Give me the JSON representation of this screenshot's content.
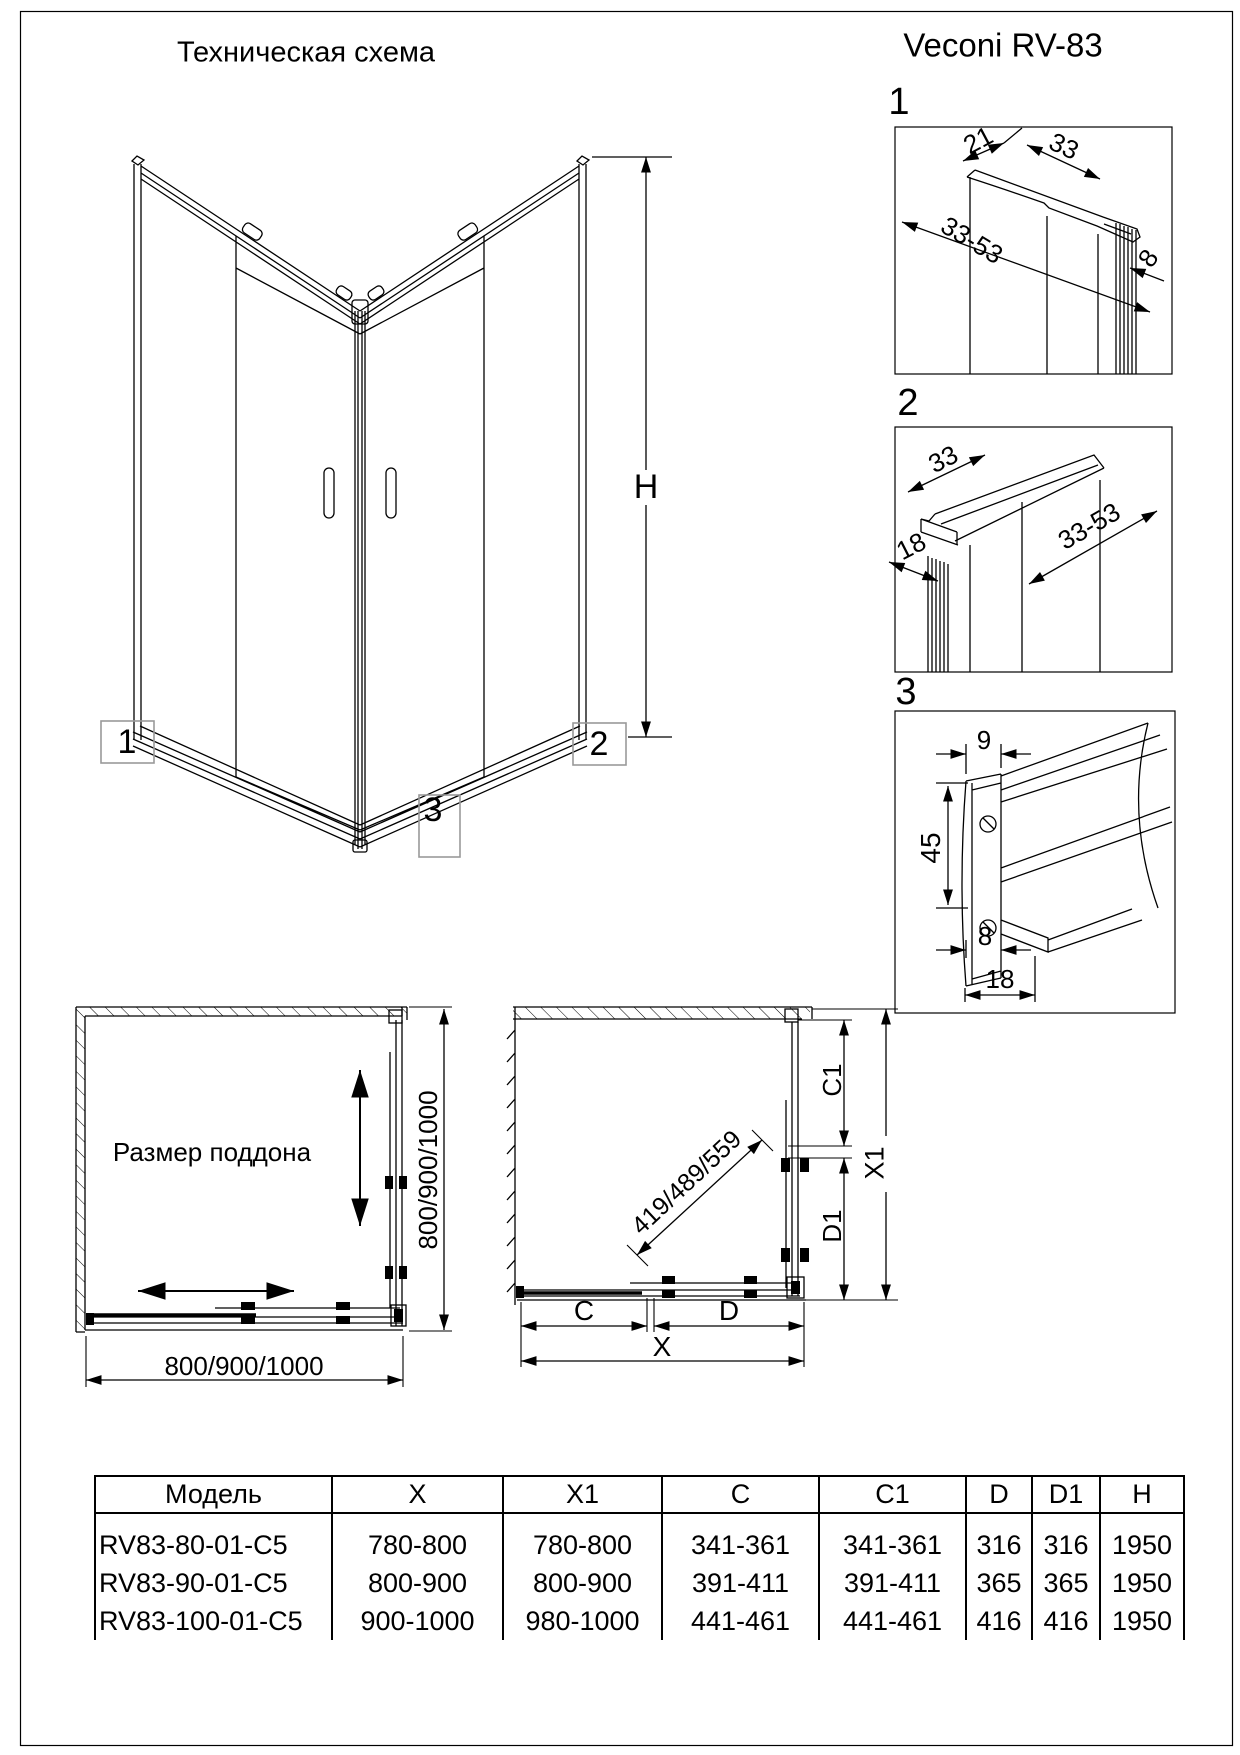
{
  "page": {
    "title": "Техническая схема",
    "brand": "Veconi RV-83"
  },
  "main_drawing": {
    "height_label": "H",
    "callouts": [
      "1",
      "2",
      "3"
    ]
  },
  "details": [
    {
      "number": "1",
      "dims": [
        "21",
        "33",
        "33-53",
        "8"
      ]
    },
    {
      "number": "2",
      "dims": [
        "33",
        "18",
        "33-53"
      ]
    },
    {
      "number": "3",
      "dims": [
        "9",
        "45",
        "8",
        "18"
      ]
    }
  ],
  "left_plan": {
    "label": "Размер поддона",
    "side_dim": "800/900/1000",
    "bottom_dim": "800/900/1000"
  },
  "right_plan": {
    "diagonal_dim": "419/489/559",
    "dims": {
      "c1": "C1",
      "d1": "D1",
      "x1": "X1",
      "c": "C",
      "d": "D",
      "x": "X"
    }
  },
  "table": {
    "headers": [
      "Модель",
      "X",
      "X1",
      "C",
      "C1",
      "D",
      "D1",
      "H"
    ],
    "rows": [
      [
        "RV83-80-01-C5",
        "780-800",
        "780-800",
        "341-361",
        "341-361",
        "316",
        "316",
        "1950"
      ],
      [
        "RV83-90-01-C5",
        "800-900",
        "800-900",
        "391-411",
        "391-411",
        "365",
        "365",
        "1950"
      ],
      [
        "RV83-100-01-C5",
        "900-1000",
        "980-1000",
        "441-461",
        "441-461",
        "416",
        "416",
        "1950"
      ]
    ]
  }
}
